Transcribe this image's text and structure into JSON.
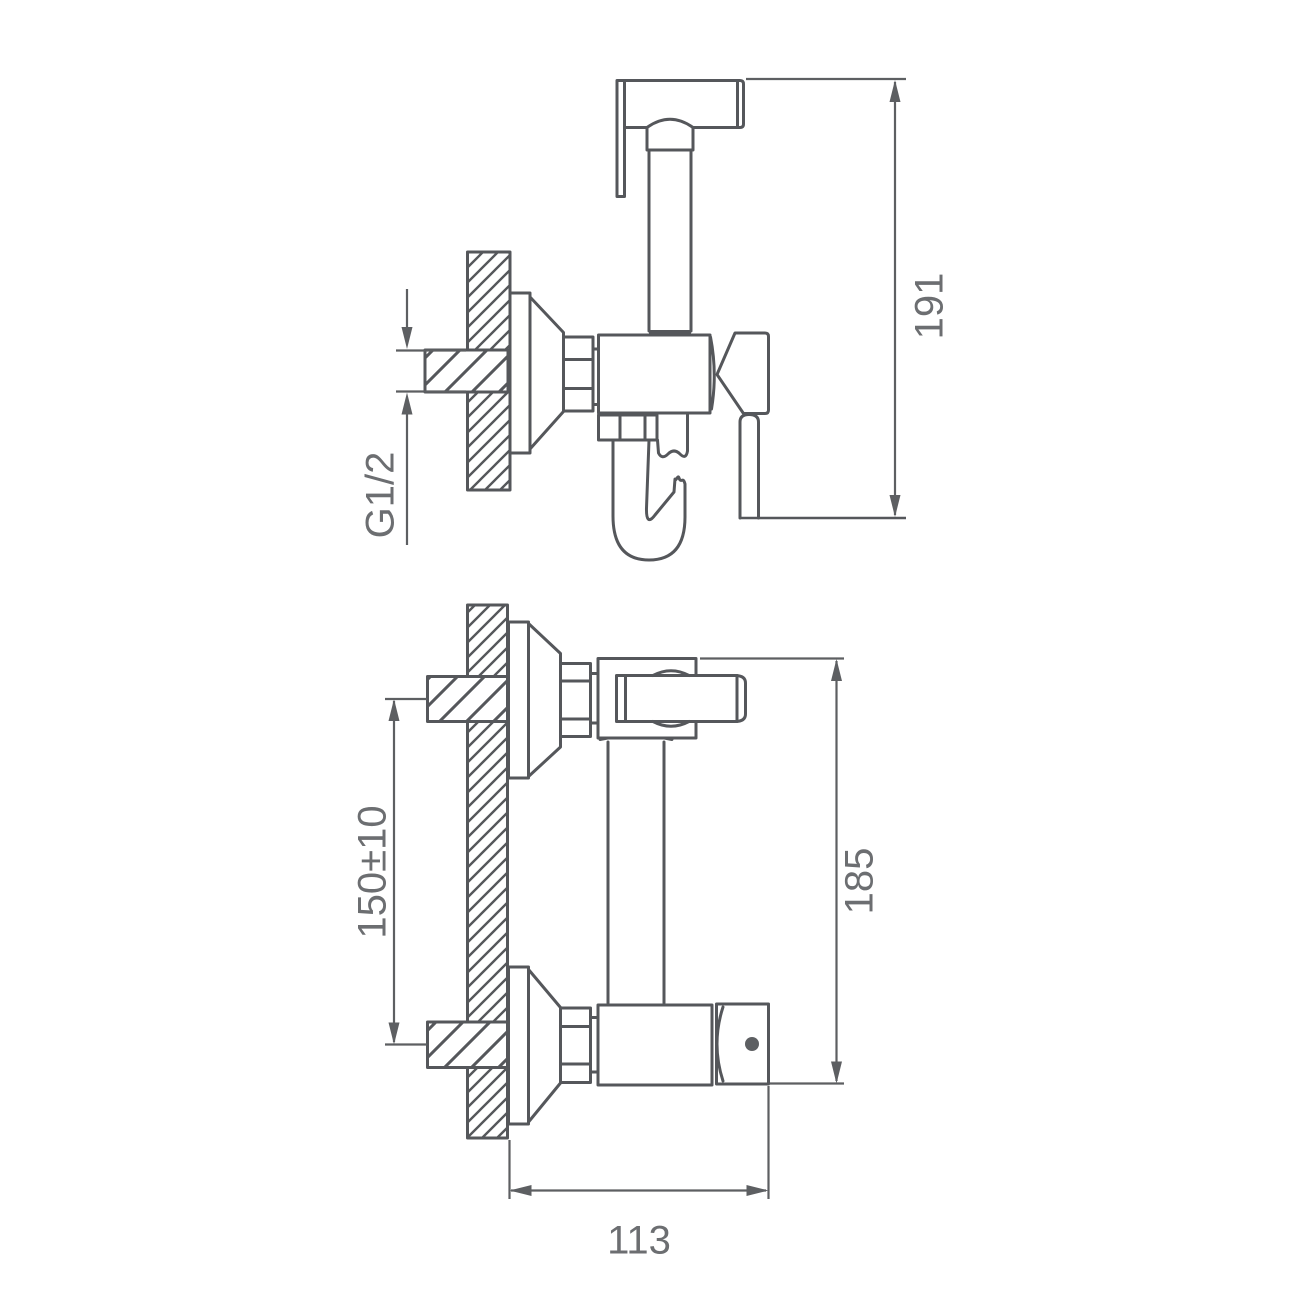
{
  "drawing": {
    "kind": "technical dimension drawing, wall-mounted hygienic shower mixer, two orthographic views",
    "colors": {
      "line": "#55575b",
      "dimension_line": "#5d5f62",
      "text": "#6c6e71",
      "background": "#ffffff"
    }
  },
  "dims": {
    "overall_height": "191",
    "thread": "G1/2",
    "mount_spacing": "150±10",
    "body_height": "185",
    "depth": "113"
  }
}
